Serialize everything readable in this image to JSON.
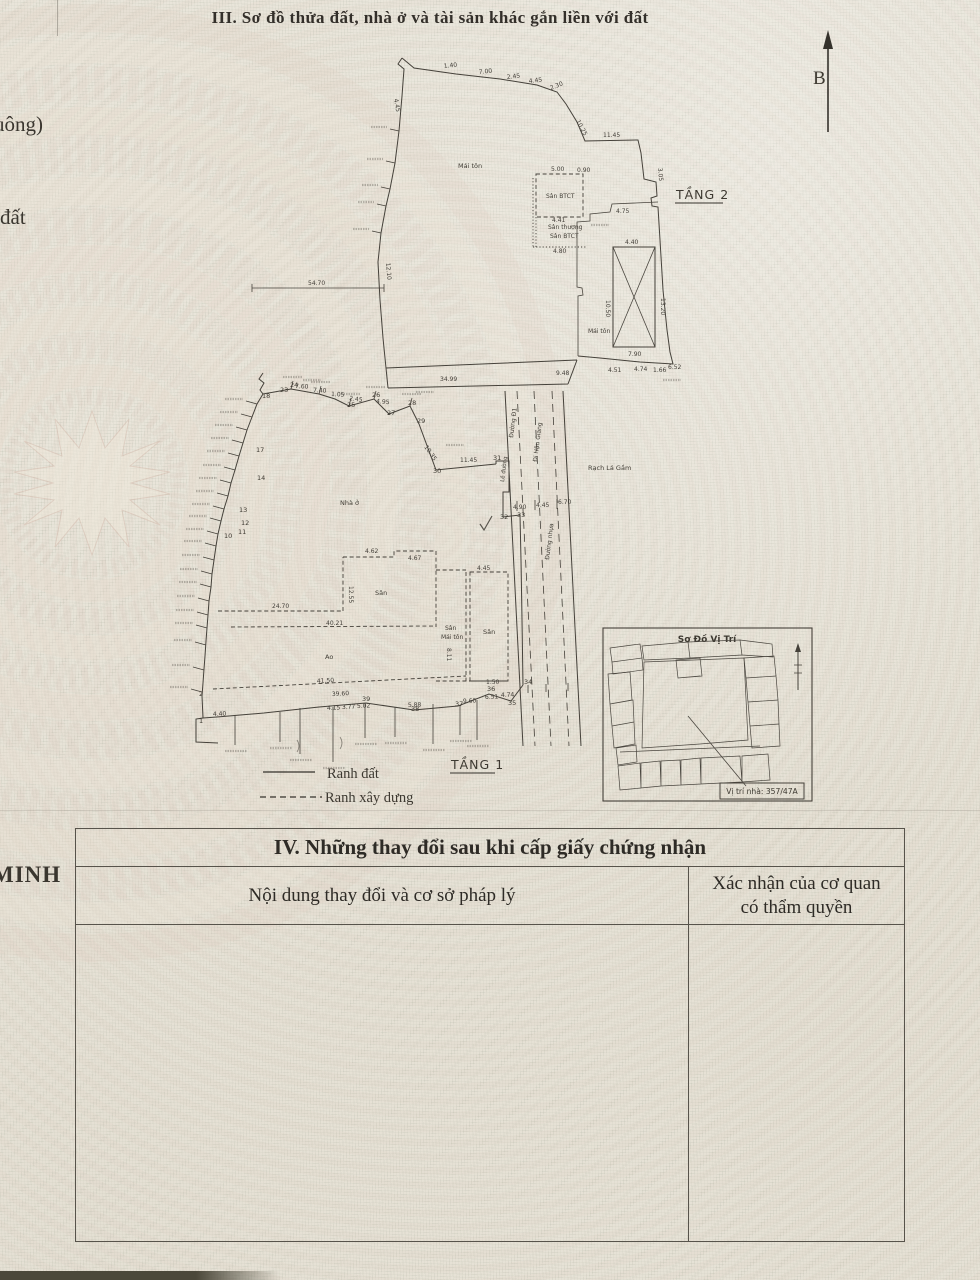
{
  "page": {
    "section3_title": "III. Sơ đồ thửa đất, nhà ở và tài sản khác gắn liền với đất",
    "compass_label": "B",
    "edge_fragments": {
      "top": "uông)",
      "middle": "đất",
      "bottom": "MINH"
    }
  },
  "drawing": {
    "floor2_label": "TẦNG 2",
    "floor1_label": "TẦNG 1",
    "legend": {
      "solid": "Ranh đất",
      "dashed": "Ranh xây dựng"
    },
    "inset": {
      "title": "Sơ Đồ Vị Trí",
      "caption": "Vị trí nhà: 357/47A"
    },
    "labels": [
      {
        "t": "Mái tôn",
        "x": 458,
        "y": 168,
        "s": 6.5
      },
      {
        "t": "Sân BTCT",
        "x": 546,
        "y": 198,
        "s": 6
      },
      {
        "t": "Sân thượng",
        "x": 548,
        "y": 229,
        "s": 6
      },
      {
        "t": "Sân BTCT",
        "x": 550,
        "y": 238,
        "s": 6
      },
      {
        "t": "Mái tôn",
        "x": 588,
        "y": 333,
        "s": 6
      },
      {
        "t": "Nhà ở",
        "x": 340,
        "y": 505,
        "s": 6.5
      },
      {
        "t": "Sân",
        "x": 375,
        "y": 595,
        "s": 6.5
      },
      {
        "t": "Sân",
        "x": 445,
        "y": 630,
        "s": 6
      },
      {
        "t": "Mái tôn",
        "x": 441,
        "y": 639,
        "s": 6
      },
      {
        "t": "Sân",
        "x": 483,
        "y": 634,
        "s": 6.5
      },
      {
        "t": "Ao",
        "x": 325,
        "y": 659,
        "s": 6.5
      },
      {
        "t": "Rạch Lá Gầm",
        "x": 588,
        "y": 470,
        "s": 6.5
      },
      {
        "t": "Đường Đ1",
        "x": 513,
        "y": 438,
        "s": 6,
        "r": -83
      },
      {
        "t": "Đi Hậu Giang",
        "x": 537,
        "y": 462,
        "s": 6,
        "r": -83
      },
      {
        "t": "Đường nhựa",
        "x": 549,
        "y": 560,
        "s": 6,
        "r": -83
      },
      {
        "t": "Lề đường",
        "x": 504,
        "y": 482,
        "s": 5.5,
        "r": -83
      }
    ],
    "dimensions": [
      {
        "t": "1.40",
        "x": 444,
        "y": 68,
        "r": -6
      },
      {
        "t": "7.00",
        "x": 479,
        "y": 74,
        "r": -6
      },
      {
        "t": "2.45",
        "x": 507,
        "y": 79,
        "r": -6
      },
      {
        "t": "4.45",
        "x": 529,
        "y": 83,
        "r": -6
      },
      {
        "t": "2.30",
        "x": 551,
        "y": 90,
        "r": -22
      },
      {
        "t": "10.25",
        "x": 576,
        "y": 121,
        "r": 62
      },
      {
        "t": "11.45",
        "x": 603,
        "y": 137
      },
      {
        "t": "3.05",
        "x": 658,
        "y": 168,
        "r": 85
      },
      {
        "t": "4.45",
        "x": 394,
        "y": 99,
        "r": 80
      },
      {
        "t": "12.10",
        "x": 386,
        "y": 263,
        "r": 85
      },
      {
        "t": "54.70",
        "x": 308,
        "y": 285
      },
      {
        "t": "34.99",
        "x": 440,
        "y": 381
      },
      {
        "t": "5.00",
        "x": 551,
        "y": 171
      },
      {
        "t": "0.90",
        "x": 577,
        "y": 172
      },
      {
        "t": "4.41",
        "x": 552,
        "y": 222
      },
      {
        "t": "4.80",
        "x": 553,
        "y": 253
      },
      {
        "t": "4.75",
        "x": 616,
        "y": 213
      },
      {
        "t": "4.40",
        "x": 625,
        "y": 244
      },
      {
        "t": "7.90",
        "x": 628,
        "y": 356
      },
      {
        "t": "10.50",
        "x": 606,
        "y": 300,
        "r": 90
      },
      {
        "t": "13.20",
        "x": 661,
        "y": 298,
        "r": 90
      },
      {
        "t": "9.48",
        "x": 556,
        "y": 375
      },
      {
        "t": "4.51",
        "x": 608,
        "y": 372
      },
      {
        "t": "4.74",
        "x": 634,
        "y": 371
      },
      {
        "t": "1.66",
        "x": 653,
        "y": 372
      },
      {
        "t": "6.52",
        "x": 668,
        "y": 369
      },
      {
        "t": "7.60",
        "x": 295,
        "y": 388,
        "r": 3
      },
      {
        "t": "7.40",
        "x": 313,
        "y": 392,
        "r": 3
      },
      {
        "t": "1.05",
        "x": 331,
        "y": 396,
        "r": 3
      },
      {
        "t": "2.45",
        "x": 349,
        "y": 400,
        "r": 8
      },
      {
        "t": "4.95",
        "x": 376,
        "y": 403,
        "r": 5
      },
      {
        "t": "10.35",
        "x": 424,
        "y": 447,
        "r": 55
      },
      {
        "t": "11.45",
        "x": 460,
        "y": 462
      },
      {
        "t": "4.90",
        "x": 513,
        "y": 509
      },
      {
        "t": "4.45",
        "x": 536,
        "y": 507
      },
      {
        "t": "6.70",
        "x": 558,
        "y": 504
      },
      {
        "t": "24.70",
        "x": 272,
        "y": 608
      },
      {
        "t": "40.21",
        "x": 326,
        "y": 625
      },
      {
        "t": "12.55",
        "x": 349,
        "y": 586,
        "r": 90
      },
      {
        "t": "4.62",
        "x": 365,
        "y": 553
      },
      {
        "t": "4.67",
        "x": 408,
        "y": 560
      },
      {
        "t": "4.45",
        "x": 477,
        "y": 570
      },
      {
        "t": "8.11",
        "x": 447,
        "y": 648,
        "r": 90
      },
      {
        "t": "1.50",
        "x": 486,
        "y": 684
      },
      {
        "t": "41.50",
        "x": 317,
        "y": 683,
        "r": -3
      },
      {
        "t": "39.60",
        "x": 332,
        "y": 696,
        "r": -3
      },
      {
        "t": "4.40",
        "x": 213,
        "y": 716,
        "r": -2
      },
      {
        "t": "4.15",
        "x": 327,
        "y": 710,
        "r": -2
      },
      {
        "t": "3.77",
        "x": 342,
        "y": 709,
        "r": -2
      },
      {
        "t": "5.02",
        "x": 357,
        "y": 708,
        "r": -2
      },
      {
        "t": "5.88",
        "x": 408,
        "y": 707,
        "r": -2
      },
      {
        "t": "9.60",
        "x": 463,
        "y": 703,
        "r": -2
      },
      {
        "t": "6.51",
        "x": 485,
        "y": 699,
        "r": -2
      },
      {
        "t": "4.74",
        "x": 501,
        "y": 697,
        "r": -2
      }
    ],
    "vertices": [
      {
        "t": "1",
        "x": 199,
        "y": 723
      },
      {
        "t": "2",
        "x": 199,
        "y": 696
      },
      {
        "t": "10",
        "x": 224,
        "y": 538
      },
      {
        "t": "11",
        "x": 238,
        "y": 534
      },
      {
        "t": "12",
        "x": 241,
        "y": 525
      },
      {
        "t": "13",
        "x": 239,
        "y": 512
      },
      {
        "t": "14",
        "x": 257,
        "y": 480
      },
      {
        "t": "17",
        "x": 256,
        "y": 452
      },
      {
        "t": "18",
        "x": 262,
        "y": 398
      },
      {
        "t": "23",
        "x": 280,
        "y": 392
      },
      {
        "t": "24",
        "x": 290,
        "y": 387
      },
      {
        "t": "25",
        "x": 347,
        "y": 407
      },
      {
        "t": "26",
        "x": 372,
        "y": 397
      },
      {
        "t": "27",
        "x": 387,
        "y": 415
      },
      {
        "t": "28",
        "x": 408,
        "y": 405
      },
      {
        "t": "29",
        "x": 417,
        "y": 423
      },
      {
        "t": "30",
        "x": 433,
        "y": 473
      },
      {
        "t": "31",
        "x": 493,
        "y": 460
      },
      {
        "t": "32",
        "x": 500,
        "y": 519
      },
      {
        "t": "33",
        "x": 517,
        "y": 517
      },
      {
        "t": "34",
        "x": 524,
        "y": 684
      },
      {
        "t": "35",
        "x": 508,
        "y": 705
      },
      {
        "t": "36",
        "x": 487,
        "y": 691
      },
      {
        "t": "37",
        "x": 455,
        "y": 706
      },
      {
        "t": "38",
        "x": 411,
        "y": 711
      },
      {
        "t": "39",
        "x": 362,
        "y": 701
      }
    ]
  },
  "section4": {
    "title": "IV. Những thay đổi sau khi cấp giấy chứng nhận",
    "col1": "Nội dung thay đổi và cơ sở pháp lý",
    "col2": "Xác nhận của cơ quan\ncó thẩm quyền"
  },
  "colors": {
    "paper": "#e9e5da",
    "ink": "#45413a",
    "drum_pink": "#d9c2b6"
  }
}
